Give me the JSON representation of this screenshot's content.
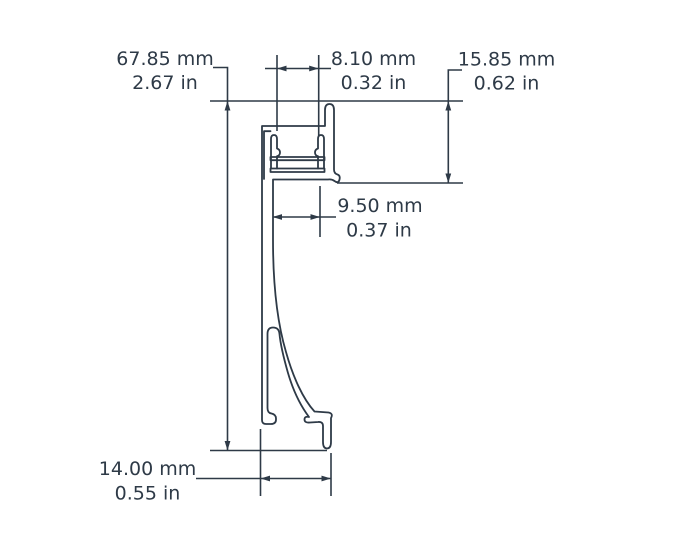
{
  "drawing": {
    "title": "aluminium-led-profile-cross-section",
    "colors": {
      "line": "#2e3a47",
      "background": "#ffffff"
    },
    "dims": {
      "total_height": {
        "mm": "67.85 mm",
        "in": "2.67 in"
      },
      "slot_width": {
        "mm": "8.10 mm",
        "in": "0.32 in"
      },
      "lip_height": {
        "mm": "15.85 mm",
        "in": "0.62 in"
      },
      "channel_width": {
        "mm": "9.50 mm",
        "in": "0.37 in"
      },
      "base_width": {
        "mm": "14.00 mm",
        "in": "0.55 in"
      }
    }
  }
}
